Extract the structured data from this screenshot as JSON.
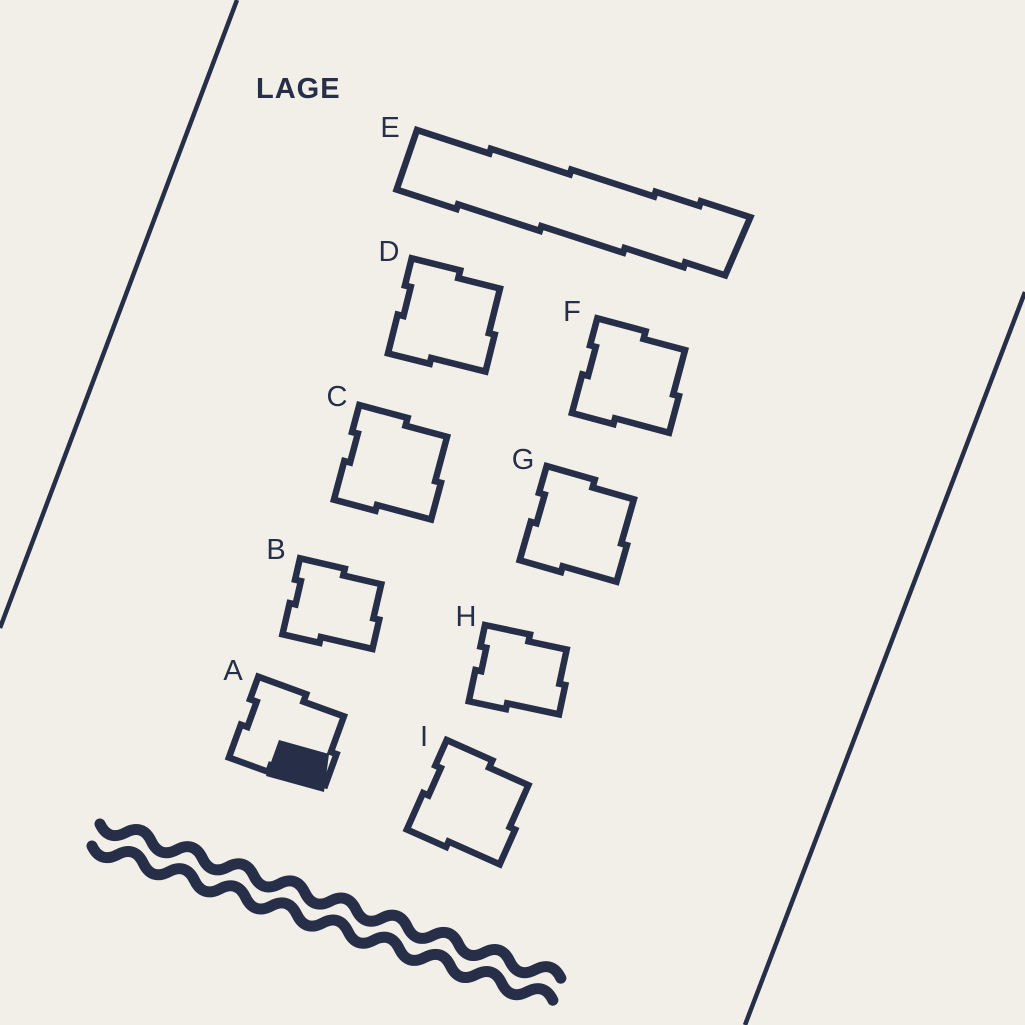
{
  "title": {
    "text": "LAGE"
  },
  "colors": {
    "background": "#f2efe9",
    "ink": "#262e48"
  },
  "canvas": {
    "width": 1025,
    "height": 1025
  },
  "styles": {
    "outline_width": 6.5,
    "boundary_width": 4.5,
    "wave_width": 11,
    "label_font_size": 29
  },
  "shapes": {
    "sq": [
      [
        0,
        0
      ],
      [
        50,
        0
      ],
      [
        50,
        8
      ],
      [
        93,
        8
      ],
      [
        93,
        54
      ],
      [
        99,
        54
      ],
      [
        99,
        92
      ],
      [
        43,
        92
      ],
      [
        43,
        98
      ],
      [
        0,
        98
      ],
      [
        0,
        58
      ],
      [
        6,
        58
      ],
      [
        6,
        28
      ],
      [
        0,
        28
      ]
    ],
    "wide": [
      [
        0,
        0
      ],
      [
        46,
        0
      ],
      [
        46,
        7
      ],
      [
        85,
        7
      ],
      [
        85,
        42
      ],
      [
        91,
        42
      ],
      [
        91,
        72
      ],
      [
        38,
        72
      ],
      [
        38,
        78
      ],
      [
        0,
        78
      ],
      [
        0,
        46
      ],
      [
        6,
        46
      ],
      [
        6,
        22
      ],
      [
        0,
        22
      ]
    ],
    "wideL": [
      [
        0,
        0
      ],
      [
        51,
        0
      ],
      [
        51,
        8
      ],
      [
        94,
        8
      ],
      [
        94,
        46
      ],
      [
        100,
        46
      ],
      [
        100,
        79
      ],
      [
        42,
        79
      ],
      [
        42,
        86
      ],
      [
        0,
        86
      ],
      [
        0,
        51
      ],
      [
        7,
        51
      ],
      [
        7,
        24
      ],
      [
        0,
        24
      ]
    ],
    "bar": [
      [
        0,
        0
      ],
      [
        76,
        0
      ],
      [
        76,
        -5
      ],
      [
        159,
        -5
      ],
      [
        159,
        -10
      ],
      [
        246,
        -10
      ],
      [
        246,
        -15
      ],
      [
        292,
        -15
      ],
      [
        292,
        -20
      ],
      [
        344,
        -20
      ],
      [
        338,
        43
      ],
      [
        296,
        43
      ],
      [
        296,
        48
      ],
      [
        234,
        48
      ],
      [
        234,
        53
      ],
      [
        148,
        53
      ],
      [
        148,
        58
      ],
      [
        62,
        58
      ],
      [
        62,
        63
      ],
      [
        -1,
        63
      ]
    ]
  },
  "buildings": [
    {
      "id": "E",
      "shape": "bar",
      "x": 417,
      "y": 130,
      "rotation": 18,
      "label": {
        "text": "E",
        "x": 390,
        "y": 128
      }
    },
    {
      "id": "D",
      "shape": "sq",
      "x": 411.7,
      "y": 258.3,
      "rotation": 14,
      "label": {
        "text": "D",
        "x": 389,
        "y": 252
      }
    },
    {
      "id": "F",
      "shape": "sq",
      "x": 597.3,
      "y": 318.3,
      "rotation": 15,
      "label": {
        "text": "F",
        "x": 572,
        "y": 312
      }
    },
    {
      "id": "C",
      "shape": "sq",
      "x": 359.3,
      "y": 405,
      "rotation": 15,
      "label": {
        "text": "C",
        "x": 337,
        "y": 397
      }
    },
    {
      "id": "G",
      "shape": "sq",
      "x": 546.7,
      "y": 466,
      "rotation": 16,
      "label": {
        "text": "G",
        "x": 523,
        "y": 460
      }
    },
    {
      "id": "B",
      "shape": "wide",
      "x": 300,
      "y": 558.3,
      "rotation": 13,
      "label": {
        "text": "B",
        "x": 276,
        "y": 550
      }
    },
    {
      "id": "H",
      "shape": "wide",
      "x": 485,
      "y": 625,
      "rotation": 12,
      "label": {
        "text": "H",
        "x": 466,
        "y": 617
      }
    },
    {
      "id": "A",
      "shape": "wideL",
      "x": 258.3,
      "y": 676.7,
      "rotation": 20,
      "label": {
        "text": "A",
        "x": 233,
        "y": 671
      }
    },
    {
      "id": "I",
      "shape": "sq",
      "x": 446.7,
      "y": 740,
      "rotation": 24,
      "label": {
        "text": "I",
        "x": 424,
        "y": 737
      }
    }
  ],
  "highlighted_unit": {
    "building": "A",
    "points": [
      [
        279,
        740
      ],
      [
        329,
        754
      ],
      [
        324,
        792
      ],
      [
        266,
        776
      ]
    ]
  },
  "boundary_lines": [
    {
      "name": "site-boundary-line-left",
      "x1": 237,
      "y1": 0,
      "x2": 0,
      "y2": 628
    },
    {
      "name": "site-boundary-line-right",
      "x1": 1025,
      "y1": 292,
      "x2": 745,
      "y2": 1025
    }
  ],
  "water": {
    "waves": [
      {
        "name": "water-wave-1",
        "x": 100,
        "y": 824,
        "angle": 18.5,
        "half_wavelength": 27,
        "halves": 18,
        "amplitude": 14
      },
      {
        "name": "water-wave-2",
        "x": 92,
        "y": 846,
        "angle": 18.5,
        "half_wavelength": 27,
        "halves": 18,
        "amplitude": 14
      }
    ]
  }
}
